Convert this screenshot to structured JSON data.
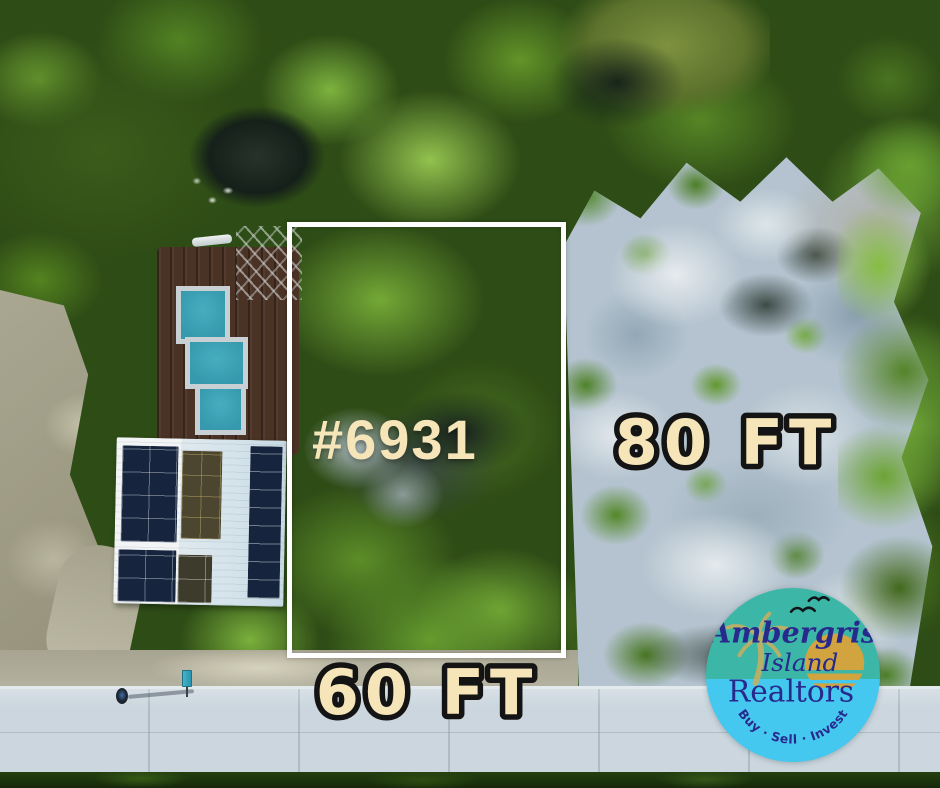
{
  "annotations": {
    "lot_number": "#6931",
    "depth_label": "80 FT",
    "frontage_label": "60 FT",
    "label_fill_color": "#f6e5b8",
    "dimension_outline_color": "#141414",
    "boundary_color": "#ffffff"
  },
  "logo": {
    "line1": "Ambergris",
    "line2": "Island",
    "line3": "Realtors",
    "tagline": "Buy · Sell · Invest",
    "top_color": "#3cb7a7",
    "bottom_color": "#45c8ef",
    "text_color": "#272a8c",
    "sun_color": "#d2a440",
    "palm_color": "#c9ae5f",
    "bird_color": "#101418"
  }
}
